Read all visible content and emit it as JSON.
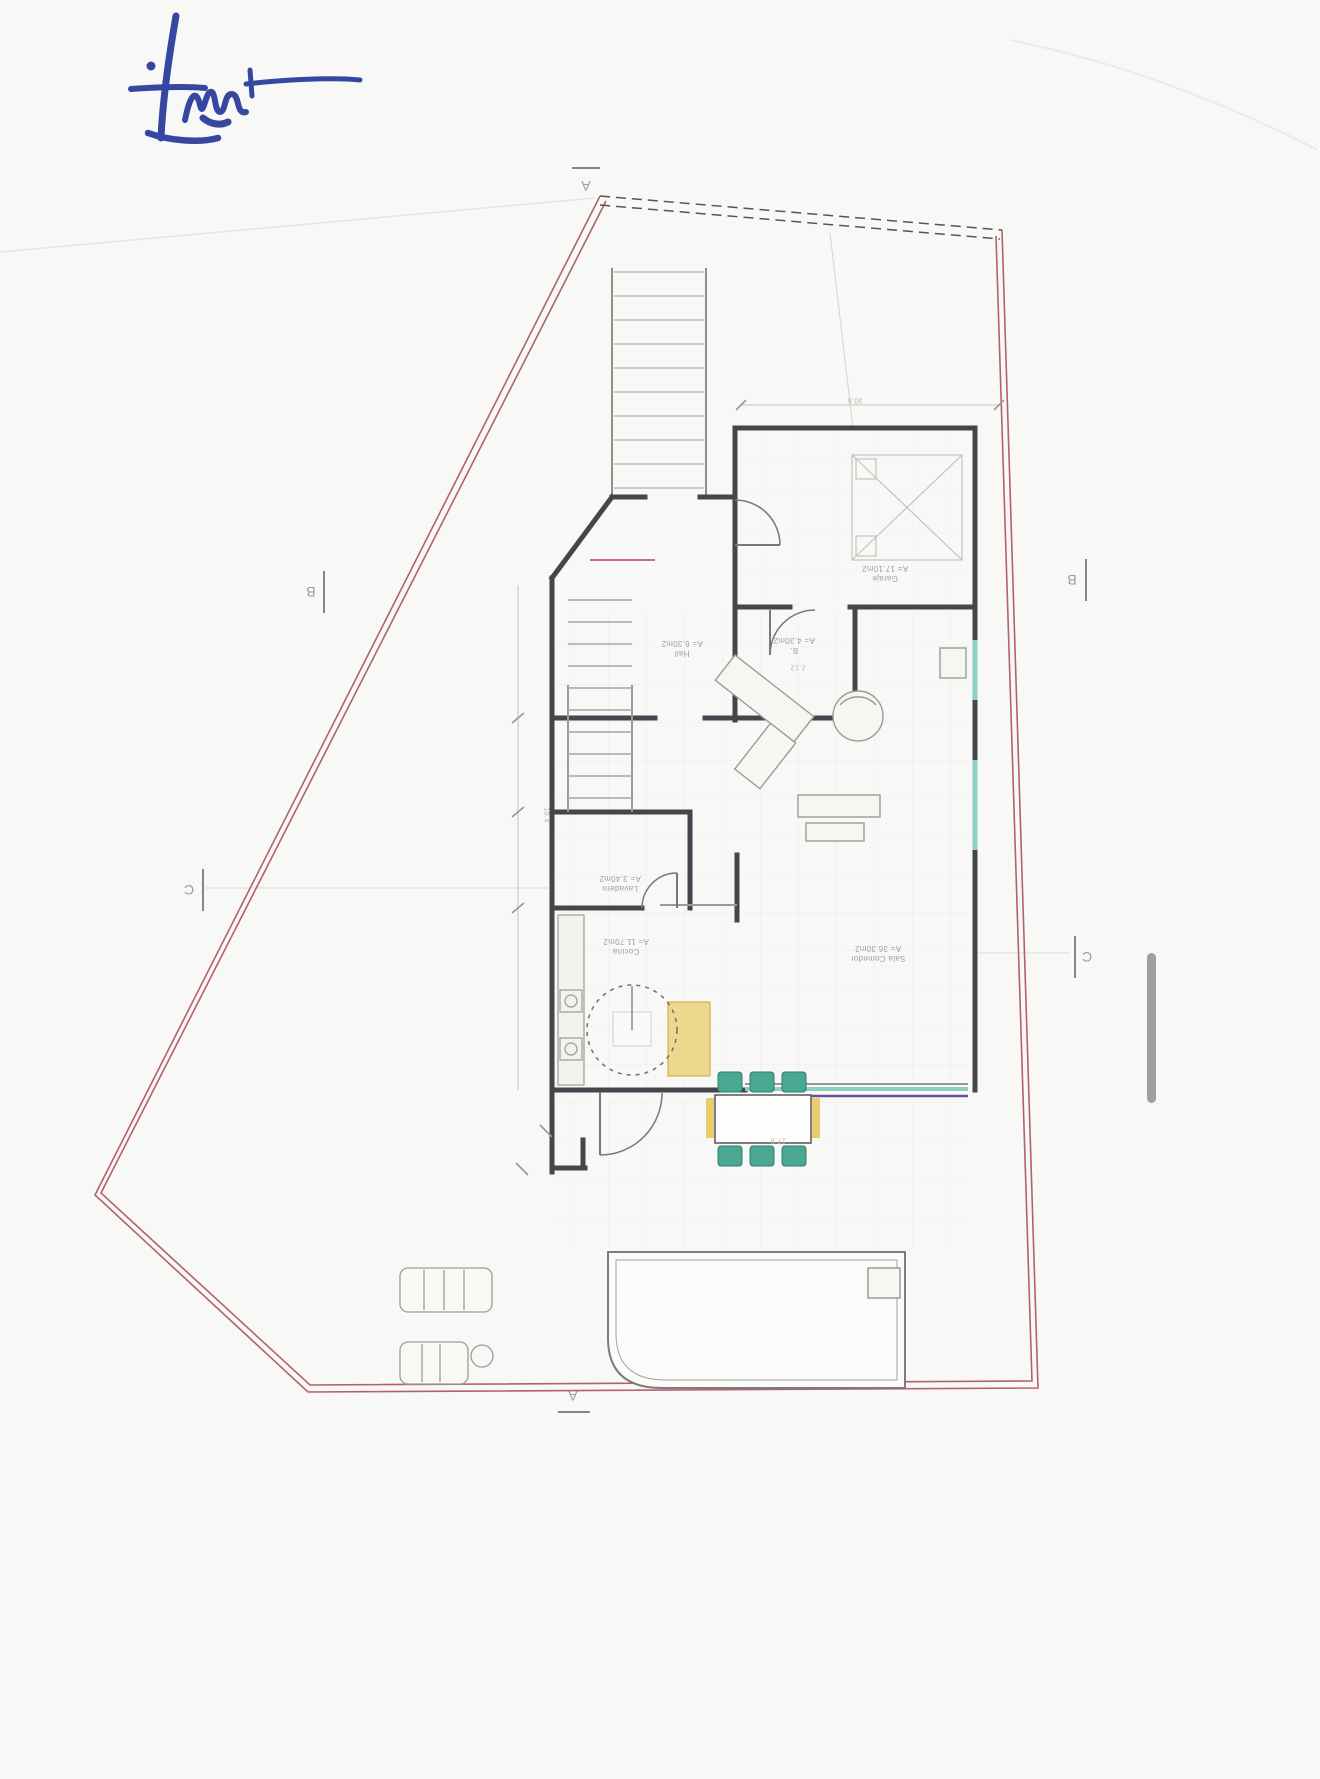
{
  "page": {
    "kind": "scanned architectural floor plan, plan rotated 180 degrees",
    "background_color": "#f8f8f6"
  },
  "signature": {
    "description": "handwritten blue ink signature, top left",
    "color": "#2b3e9c"
  },
  "plan": {
    "section_markers": {
      "a": "A",
      "b": "B",
      "c": "C"
    },
    "rooms": [
      {
        "name": "Garaje",
        "area": "A= 17.10m2"
      },
      {
        "name": "Hall",
        "area": "A= 6.30m2"
      },
      {
        "name": "B.",
        "area": "A= 4.30m2"
      },
      {
        "name": "Lavadero",
        "area": "A= 3.40m2"
      },
      {
        "name": "Cocina",
        "area": "A= 11.70m2"
      },
      {
        "name": "Sala Comedor",
        "area": "A= 36.30m2"
      }
    ],
    "dimensions": {
      "garage_top": "30.6",
      "bath": "2.12",
      "stairs": "10.4",
      "terrace": "27.8"
    },
    "colors": {
      "boundary_red": "#b4606e",
      "wall_dark": "#45454c",
      "glass_teal": "#8fd0c4",
      "glass_purple": "#6a4f9e",
      "furniture_green": "#4aa892",
      "furniture_yellow": "#e6c455",
      "signature_blue": "#2b3e9c"
    }
  },
  "scrollbar": {
    "present": true
  }
}
